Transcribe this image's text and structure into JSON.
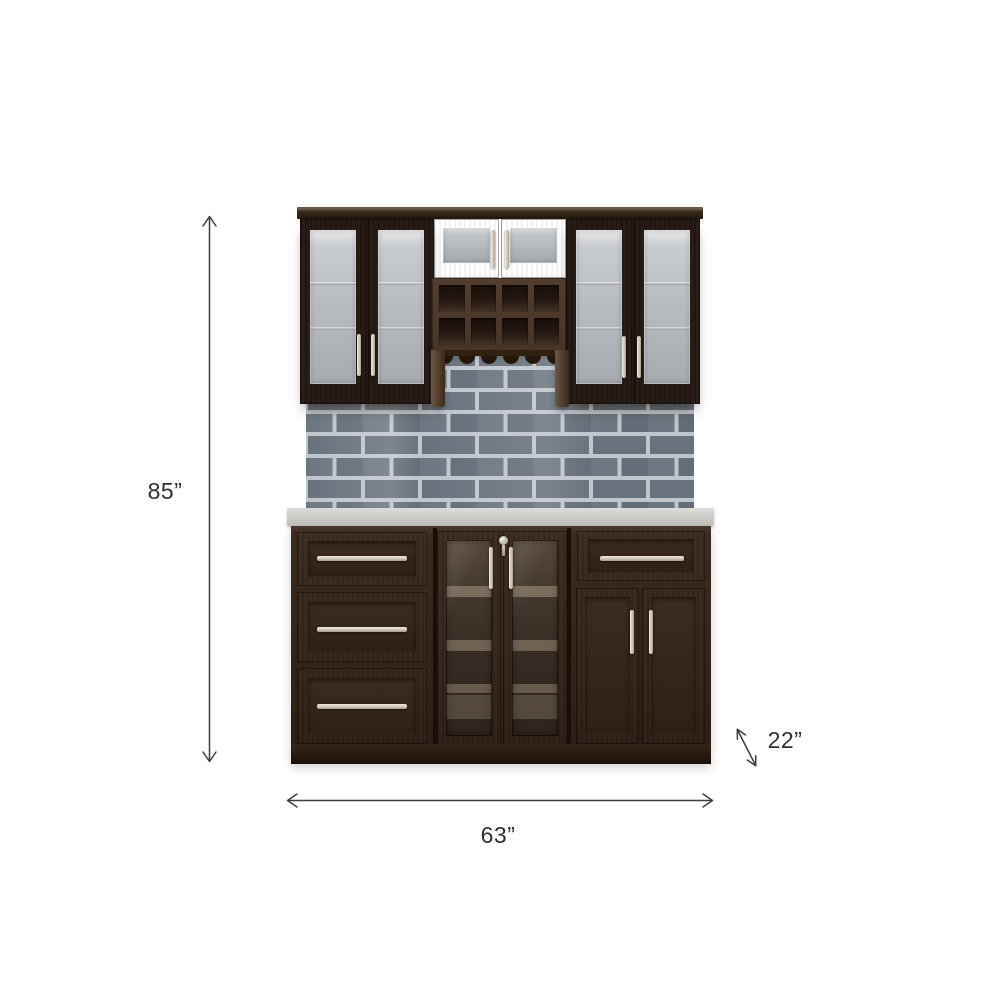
{
  "scene": {
    "type": "product-dimension-diagram",
    "subject": "Espresso home bar cabinet set with glass-door wall cabinets, wine bottle cubbies, stemware rack, gray subway-tile backsplash, light gray countertop, and a base unit with drawers and doors",
    "background": "#ffffff"
  },
  "annotations": {
    "height": {
      "label": "85”",
      "arrow": "vertical-double-arrow"
    },
    "width": {
      "label": "63”",
      "arrow": "horizontal-double-arrow"
    },
    "depth": {
      "label": "22”",
      "arrow": "diagonal-double-arrow"
    }
  },
  "colors": {
    "wood_frame": "#4c3a2f",
    "wood_panel": "#32231a",
    "wood_crown": "#23170e",
    "glass_light": "#c3c7ca",
    "glass_dark": "#3e342b",
    "handle_metal": "#d6cfc2",
    "tile": "#68727c",
    "grout": "#bfc5cb",
    "countertop": "#cfcecb",
    "dimension_line": "#3d3d3d",
    "text": "#2f2f2f"
  }
}
